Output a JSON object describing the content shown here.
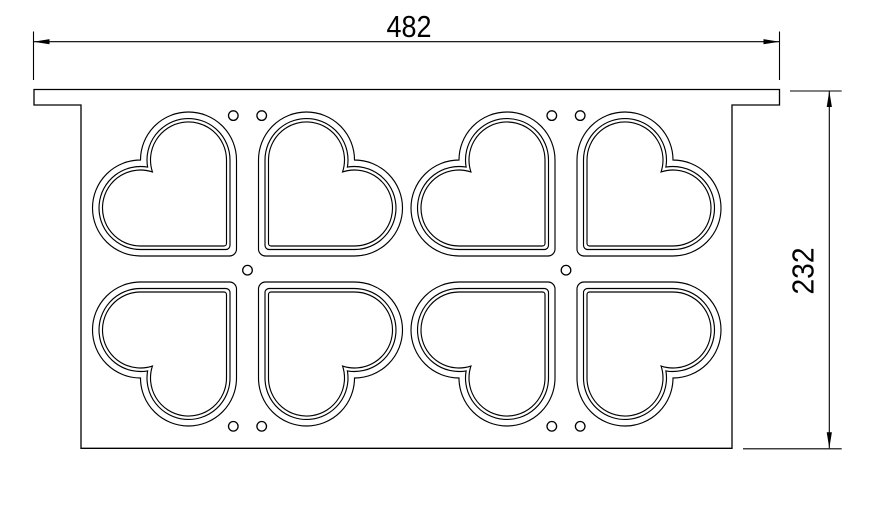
{
  "title": "Heart mold tray technical drawing",
  "dimensions": {
    "width": {
      "label": "482"
    },
    "height": {
      "label": "232"
    }
  },
  "drawing": {
    "canvas": {
      "w": 877,
      "h": 506
    },
    "background": "#ffffff",
    "line_color": "#000000",
    "tray_outline": [
      [
        34,
        89.5
      ],
      [
        779.5,
        89.5
      ],
      [
        779.5,
        105
      ],
      [
        732,
        105
      ],
      [
        732,
        448.3
      ],
      [
        81,
        448.3
      ],
      [
        81,
        105
      ],
      [
        34,
        105
      ]
    ],
    "heart": {
      "size": 144,
      "offset_x": 11,
      "offset_y": 13,
      "insets": [
        0,
        6.5,
        10
      ],
      "point_radius": 7,
      "rotations": [
        0,
        90,
        270,
        180
      ]
    },
    "clusters": [
      {
        "cx": 247.5,
        "cy": 269
      },
      {
        "cx": 566.0,
        "cy": 269
      }
    ],
    "hole": {
      "r": 4.8,
      "positions": [
        [
          -14.2,
          -153.4
        ],
        [
          14.2,
          -153.4
        ],
        [
          0,
          1.2
        ],
        [
          -14.2,
          157.3
        ],
        [
          14.2,
          157.3
        ]
      ]
    },
    "dim_width": {
      "y": 41.7,
      "x1": 33.5,
      "x2": 779.5,
      "ext_y1": 31.5,
      "ext_y2": 80
    },
    "dim_height": {
      "x": 829.3,
      "y1": 91,
      "y2": 448.3,
      "ext_top": [
        790,
        841.7,
        91
      ],
      "ext_bottom": [
        743,
        841.7,
        448.8
      ]
    },
    "arrow": {
      "len": 16,
      "hw": 2.6
    }
  }
}
